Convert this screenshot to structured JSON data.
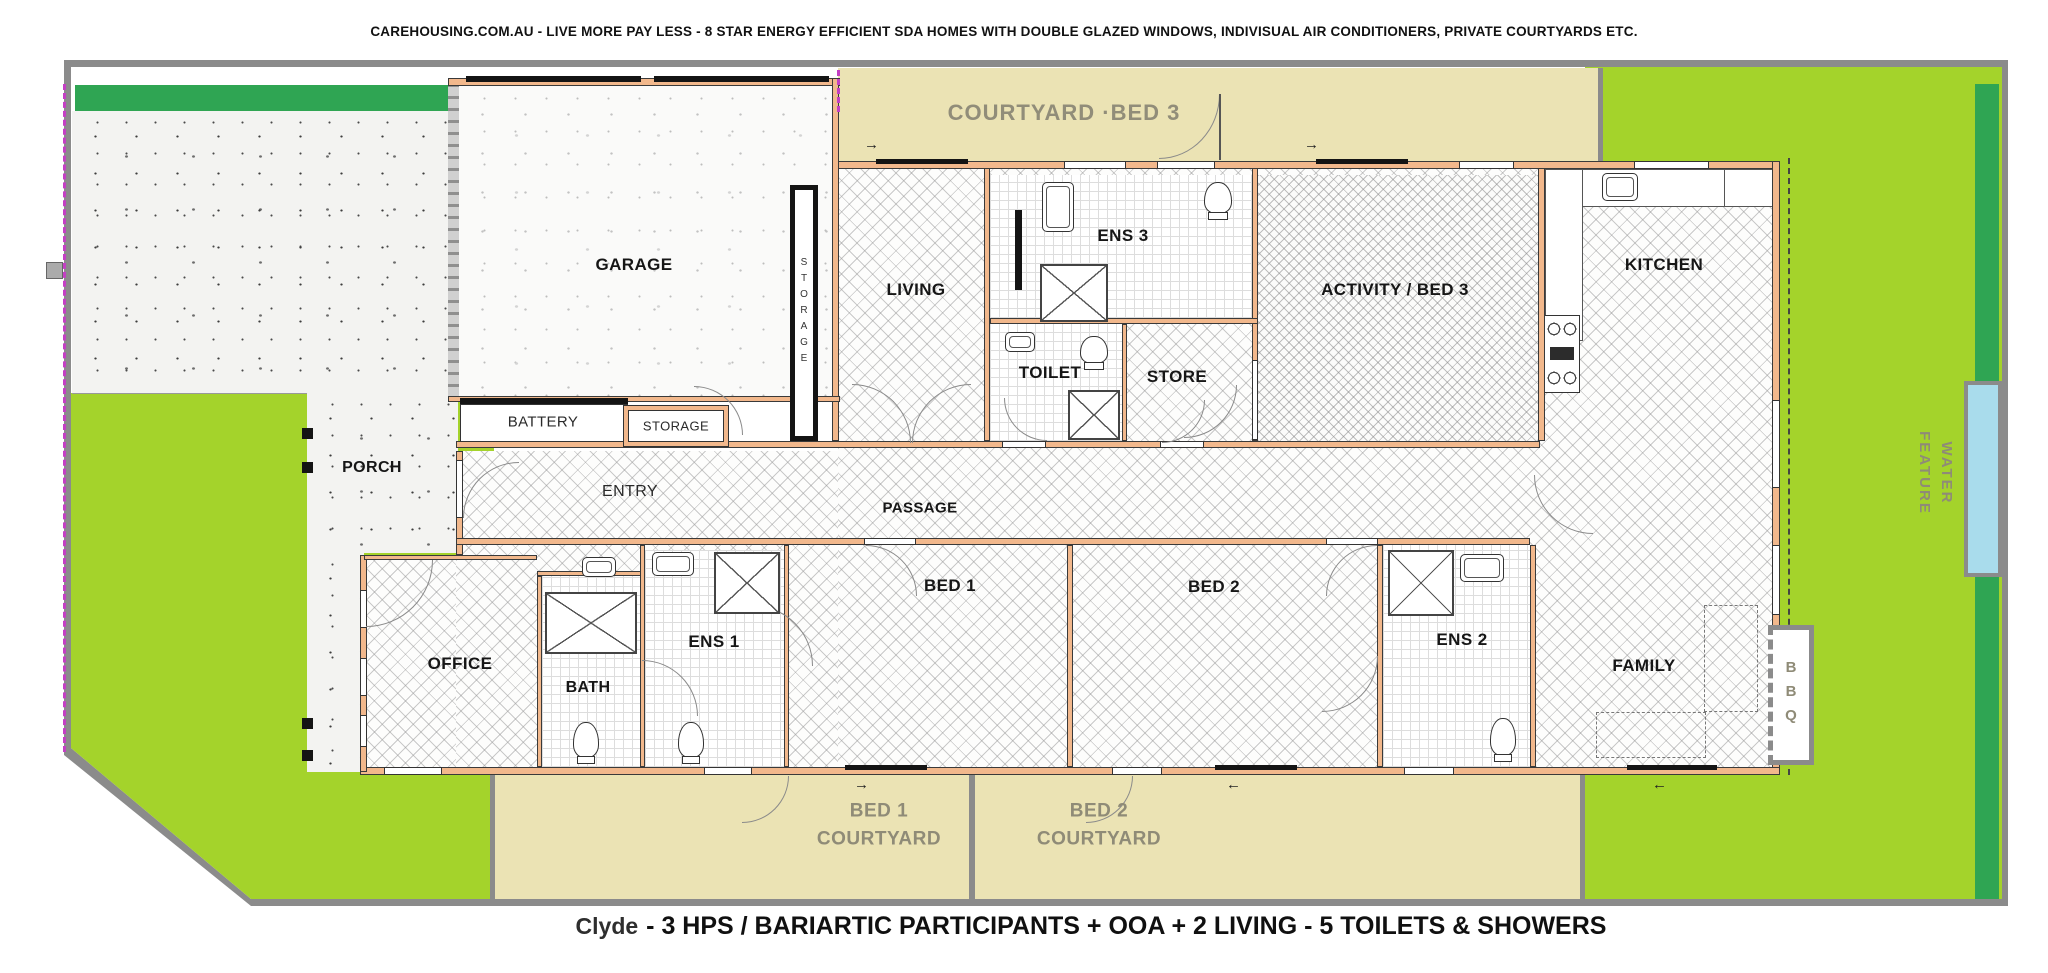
{
  "header": {
    "tagline": "CAREHOUSING.COM.AU - LIVE MORE PAY LESS - 8 STAR ENERGY EFFICIENT SDA HOMES WITH DOUBLE GLAZED WINDOWS, INDIVISUAL AIR CONDITIONERS, PRIVATE COURTYARDS ETC."
  },
  "footer": {
    "plan_name": "Clyde",
    "description": "- 3 HPS / BARIARTIC PARTICIPANTS + OOA + 2 LIVING - 5 TOILETS & SHOWERS"
  },
  "rooms": {
    "garage": "GARAGE",
    "storage_tall": "STORAGE",
    "battery": "BATTERY",
    "storage_small": "STORAGE",
    "living": "LIVING",
    "ens3": "ENS 3",
    "toilet": "TOILET",
    "store": "STORE",
    "activity_bed3": "ACTIVITY / BED 3",
    "kitchen": "KITCHEN",
    "entry": "ENTRY",
    "passage": "PASSAGE",
    "porch": "PORCH",
    "office": "OFFICE",
    "bath": "BATH",
    "ens1": "ENS 1",
    "bed1": "BED 1",
    "bed2": "BED 2",
    "ens2": "ENS 2",
    "family": "FAMILY"
  },
  "outdoor": {
    "courtyard_bed3": "COURTYARD ·BED 3",
    "bed1_courtyard_line1": "BED 1",
    "bed1_courtyard_line2": "COURTYARD",
    "bed2_courtyard_line1": "BED 2",
    "bed2_courtyard_line2": "COURTYARD",
    "bbq": "BBQ",
    "water_feature_line1": "WATER",
    "water_feature_line2": "FEATURE"
  },
  "icons": {
    "arrow_right": "→",
    "arrow_left": "←"
  },
  "colors": {
    "grass": "#a4d32b",
    "dark_green": "#2fa553",
    "courtyard_tan": "#ebe3b4",
    "wall_orange": "#f2b88c",
    "boundary_gray": "#8b8b8b",
    "water_blue": "#a9dcec",
    "outdoor_label_gray": "#918d79"
  }
}
